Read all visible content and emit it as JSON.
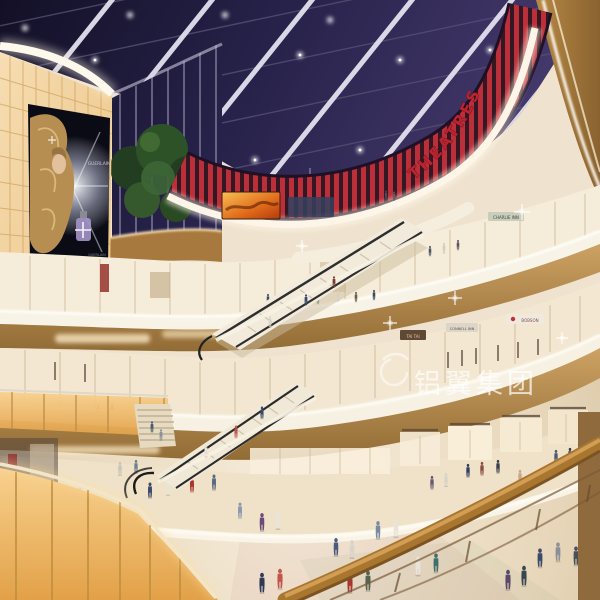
{
  "scene": {
    "title": "Shopping mall atrium interior rendering",
    "setting": "Multi-level retail atrium with dark glass skylight, curved balconies, escalators and shoppers",
    "watermark": {
      "text": "铝翼集团"
    },
    "signs": {
      "theatres": "THEATRES",
      "billboard_brand": "GUERLAIN",
      "billboard_brand_small": "GUERLAIN",
      "shop_1": "CHARLIE INN",
      "shop_2": "TAI TAI",
      "shop_3": "CONNELL INN",
      "shop_4": "BOBSON"
    },
    "colors": {
      "skylight_glass": "#221d40",
      "structure_white": "#ece9f4",
      "theatre_red": "#bb2f3a",
      "sign_red": "#bb2330",
      "wall_glow_amber": "#f2cf96",
      "wood": "#b98c4f",
      "fascia_cream": "#f6efe0",
      "floor_beige": "#e9dabd",
      "watermark_white": "#ffffff"
    }
  }
}
